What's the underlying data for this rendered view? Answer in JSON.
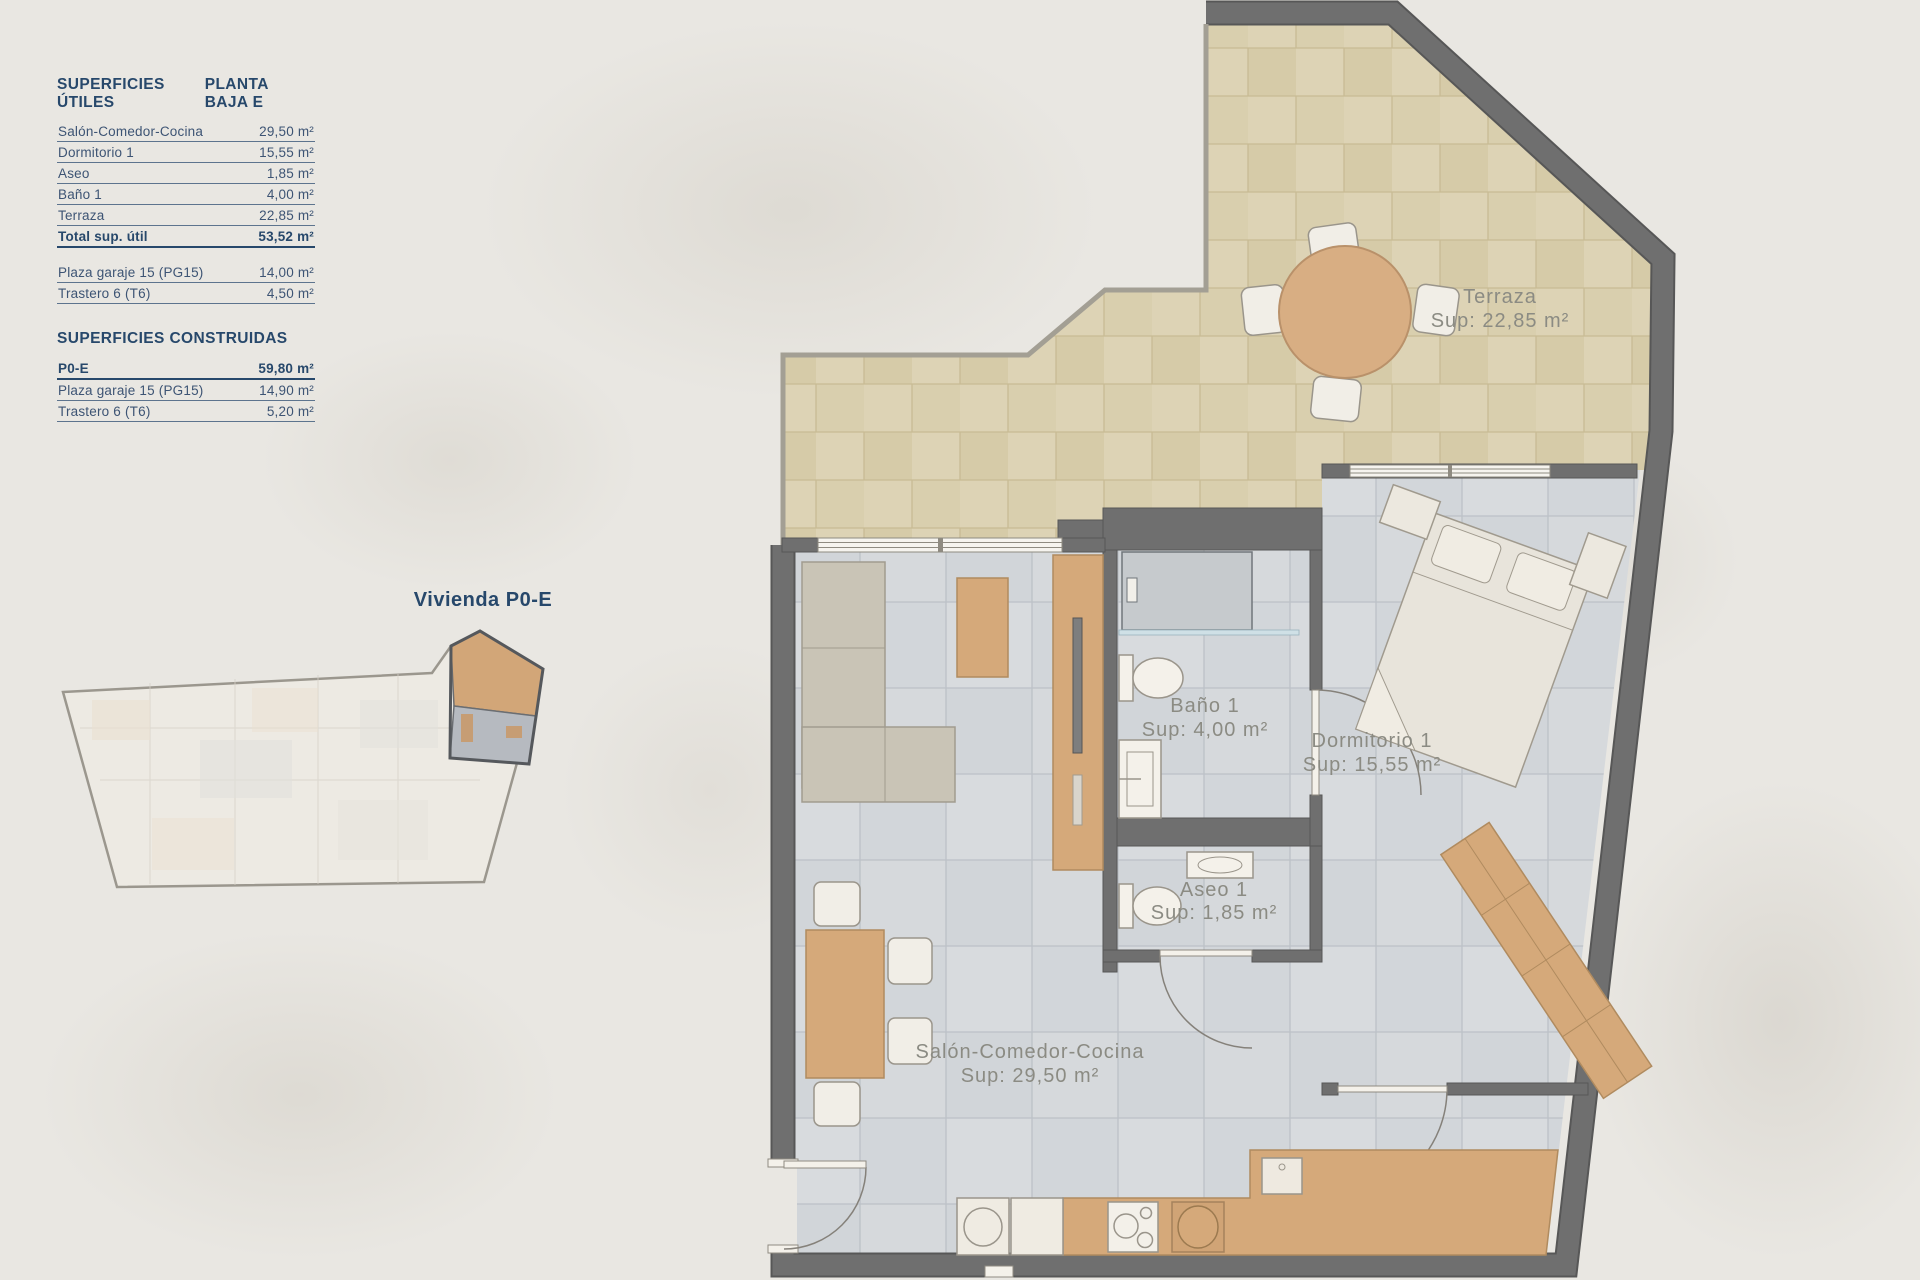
{
  "legend": {
    "title": "SUPERFICIES ÚTILES",
    "plan_title": "PLANTA BAJA E",
    "rows": [
      {
        "label": "Salón-Comedor-Cocina",
        "value": "29,50 m²"
      },
      {
        "label": "Dormitorio 1",
        "value": "15,55 m²"
      },
      {
        "label": "Aseo",
        "value": "1,85 m²"
      },
      {
        "label": "Baño 1",
        "value": "4,00 m²"
      },
      {
        "label": "Terraza",
        "value": "22,85 m²"
      }
    ],
    "total": {
      "label": "Total sup. útil",
      "value": "53,52 m²"
    },
    "extras": [
      {
        "label": "Plaza garaje 15 (PG15)",
        "value": "14,00 m²"
      },
      {
        "label": "Trastero 6 (T6)",
        "value": "4,50 m²"
      }
    ]
  },
  "constructed": {
    "title": "SUPERFICIES CONSTRUIDAS",
    "rows": [
      {
        "label": "P0-E",
        "value": "59,80 m²"
      },
      {
        "label": "Plaza garaje 15 (PG15)",
        "value": "14,90 m²"
      },
      {
        "label": "Trastero 6 (T6)",
        "value": "5,20 m²"
      }
    ]
  },
  "overview": {
    "caption": "Vivienda P0-E"
  },
  "plan": {
    "rooms": [
      {
        "name": "Terraza",
        "sup": "Sup: 22,85 m²"
      },
      {
        "name": "Baño 1",
        "sup": "Sup: 4,00 m²"
      },
      {
        "name": "Dormitorio 1",
        "sup": "Sup: 15,55 m²"
      },
      {
        "name": "Aseo 1",
        "sup": "Sup: 1,85 m²"
      },
      {
        "name": "Salón-Comedor-Cocina",
        "sup": "Sup: 29,50 m²"
      }
    ]
  },
  "colors": {
    "background": "#e9e7e2",
    "accent_navy": "#27486b",
    "wall_gray": "#6f6f6f",
    "floor_tile": "#d5d8db",
    "terrace_tile": "#ddd3b5",
    "wood": "#d5a97a",
    "label_gray": "#8b8b83"
  }
}
